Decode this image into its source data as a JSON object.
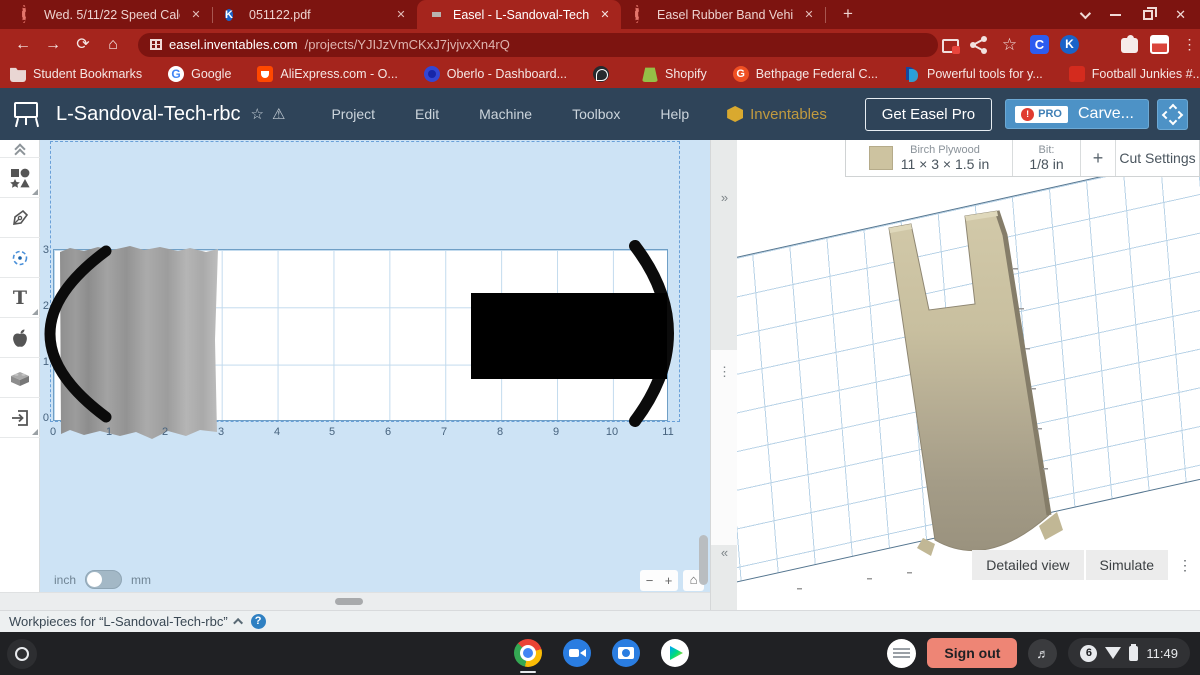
{
  "browser": {
    "tabs": [
      {
        "label": "Wed. 5/11/22 Speed Calculation",
        "icon": "loading-dashed-circle",
        "active": false
      },
      {
        "label": "051122.pdf",
        "icon": "kami-k",
        "active": false
      },
      {
        "label": "Easel - L-Sandoval-Tech-rbc",
        "icon": "easel-screen",
        "active": true
      },
      {
        "label": "Easel Rubber Band Vehicle",
        "icon": "loading-dashed-circle",
        "active": false
      }
    ],
    "glyphs": {
      "tab_close": "✕",
      "new_tab": "+",
      "bookmarks_overflow": "»",
      "kami_letter": "K"
    },
    "window_controls": [
      "chevron-down",
      "minimize",
      "restore",
      "close"
    ],
    "nav": {
      "back": "←",
      "forward": "→",
      "reload": "⟳",
      "home": "⌂"
    },
    "url_host": "easel.inventables.com",
    "url_path": "/projects/YJIJzVmCKxJ7jvjvxXn4rQ",
    "action_icons": [
      "cast",
      "share",
      "bookmark-star",
      "clever",
      "kami",
      "trash",
      "extensions-puzzle",
      "profile-avatar",
      "menu-dots"
    ],
    "action_glyphs": {
      "star": "☆",
      "clever": "C",
      "kami": "K",
      "dots": "⋮"
    },
    "bookmarks": [
      {
        "label": "Student Bookmarks",
        "icon": "folder"
      },
      {
        "label": "Google",
        "icon": "google-g",
        "letter": "G"
      },
      {
        "label": "AliExpress.com - O...",
        "icon": "aliexpress"
      },
      {
        "label": "Oberlo - Dashboard...",
        "icon": "oberlo"
      },
      {
        "label": "",
        "icon": "globe"
      },
      {
        "label": "Shopify",
        "icon": "shopify"
      },
      {
        "label": "Bethpage Federal C...",
        "icon": "bethpage",
        "letter": "G"
      },
      {
        "label": "Powerful tools for y...",
        "icon": "paypal"
      },
      {
        "label": "Football Junkies #...",
        "icon": "football"
      },
      {
        "label": "Facebook - Log In o...",
        "icon": "facebook",
        "letter": "f"
      }
    ]
  },
  "easel": {
    "header": {
      "title": "L-Sandoval-Tech-rbc",
      "star": "☆",
      "warning": "⚠",
      "menus": [
        "Project",
        "Edit",
        "Machine",
        "Toolbox",
        "Help"
      ],
      "brand": "Inventables",
      "get_pro_label": "Get Easel Pro",
      "pro_badge": "PRO",
      "pro_alert": "!",
      "carve_label": "Carve..."
    },
    "toolbar_icons": [
      "collapse-chevrons",
      "shapes",
      "pen",
      "drill-origin",
      "text",
      "apple-design-library",
      "projects-brick",
      "import"
    ],
    "text_tool_glyph": "T",
    "material": {
      "name": "Birch Plywood",
      "dimensions": "11 × 3 × 1.5 in",
      "bit_label": "Bit:",
      "bit_value": "1/8 in",
      "add": "+",
      "cut_settings": "Cut Settings"
    },
    "canvas": {
      "x_ticks": [
        "0",
        "1",
        "2",
        "3",
        "4",
        "5",
        "6",
        "7",
        "8",
        "9",
        "10",
        "11"
      ],
      "y_ticks": [
        "3",
        "2",
        "1",
        "0"
      ],
      "unit_left": "inch",
      "unit_right": "mm",
      "zoom_out": "−",
      "zoom_in": "+",
      "home": "⌂"
    },
    "handles": {
      "expand": "»",
      "drag": "⋮",
      "collapse": "«"
    },
    "workpieces": {
      "label": "Workpieces for “L-Sandoval-Tech-rbc”",
      "help": "?"
    },
    "preview": {
      "detailed_view": "Detailed view",
      "simulate": "Simulate",
      "menu": "⋮"
    }
  },
  "shelf": {
    "apps": [
      "launcher",
      "chrome",
      "meet",
      "camera",
      "play-store"
    ],
    "sign_out": "Sign out",
    "notifications": "6",
    "time": "11:49"
  },
  "colors": {
    "chrome_frame": "#7d1410",
    "chrome_toolbar": "#a5251d",
    "easel_header": "#2f4459",
    "carve_blue": "#4d92c6",
    "canvas_bg": "#cde3f5",
    "material_tan": "#cdc3a0",
    "signout_salmon": "#ee8575",
    "shelf_bg": "#202124"
  }
}
